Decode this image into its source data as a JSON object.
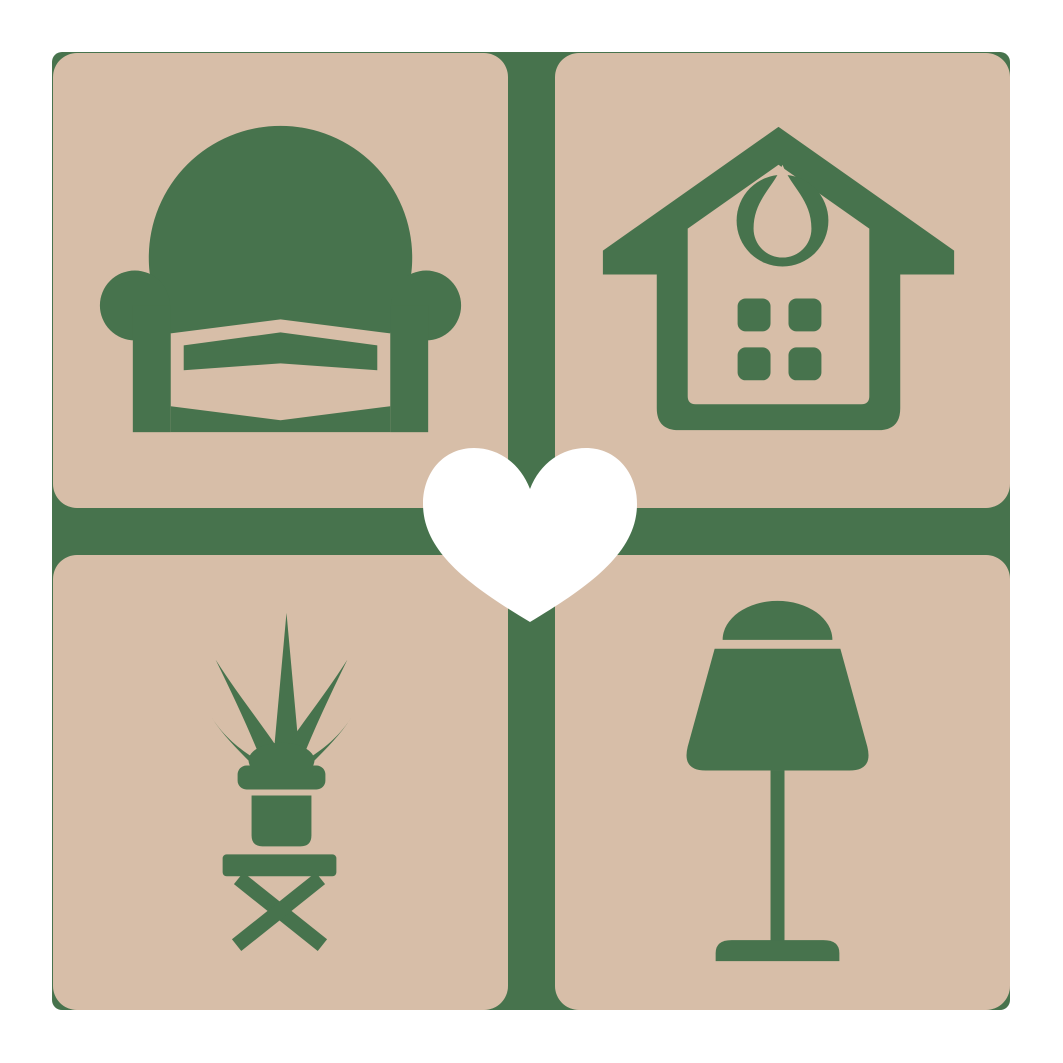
{
  "app": {
    "type": "logo-graphic",
    "description": "Home decor lover emblem: four tan rounded tiles with green furniture icons (armchair, house, potted plant on stool, table lamp) separated by a green cross, with a white heart at the center"
  },
  "colors": {
    "background": "#ffffff",
    "tile": "#d7bea8",
    "accent": "#47734d",
    "heart": "#ffffff"
  },
  "tiles": [
    {
      "id": "armchair",
      "label": "Armchair",
      "position": "top-left"
    },
    {
      "id": "house",
      "label": "House with windows",
      "position": "top-right"
    },
    {
      "id": "plant",
      "label": "Potted plant on stool",
      "position": "bottom-left"
    },
    {
      "id": "lamp",
      "label": "Table lamp",
      "position": "bottom-right"
    }
  ],
  "center": {
    "icon": "heart",
    "label": "Heart",
    "color": "#ffffff"
  },
  "layout_meta": {
    "grid": "2x2",
    "divider": "green cross",
    "outer_margin_px": 52
  }
}
